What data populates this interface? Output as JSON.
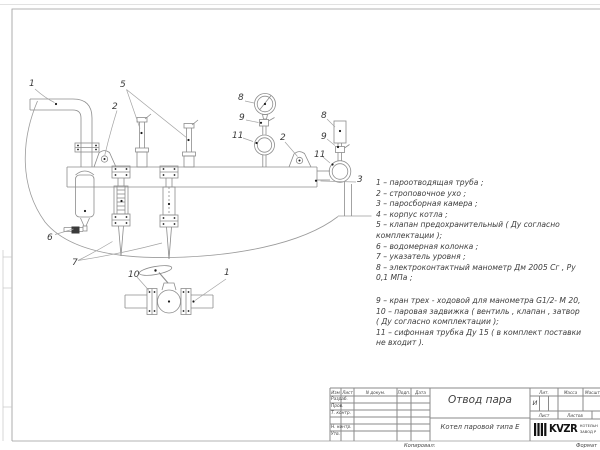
{
  "colors": {
    "drawing_line": "#8c8c8c",
    "frame_line": "#9a9a9a",
    "leader_line": "#a3a3a3",
    "text": "#3c3c3c",
    "dot": "#1b1b1b"
  },
  "drawing": {
    "callouts": [
      {
        "n": "1"
      },
      {
        "n": "5"
      },
      {
        "n": "2"
      },
      {
        "n": "8"
      },
      {
        "n": "9"
      },
      {
        "n": "11"
      },
      {
        "n": "2"
      },
      {
        "n": "8"
      },
      {
        "n": "9"
      },
      {
        "n": "11"
      },
      {
        "n": "3"
      },
      {
        "n": "6"
      },
      {
        "n": "7"
      },
      {
        "n": "10"
      },
      {
        "n": "1"
      }
    ]
  },
  "legend": {
    "lines": [
      "1 –  пароотводящая труба ;",
      "2 –  строповочное ухо ;",
      "3 –  паросборная камера ;",
      "4 –  корпус котла ;",
      "5 –  клапан предохранительный  ( Ду согласно",
      "комплектации );",
      "6 –  водомерная колонка ;",
      "7 – указатель уровня ;",
      "8 – электроконтактный манометр  Дм 2005 Сг ,  Ру",
      "0,1  МПа ;",
      "9 –  кран трех - ходовой для манометра   G1/2- М 20,",
      "10 –  паровая задвижка  ( вентиль ,  клапан ,  затвор",
      "( Ду согласно комплектации );",
      "11 –  сифонная трубка  Ду 15  ( в комплект поставки",
      "не входит )."
    ]
  },
  "title_block": {
    "title": "Отвод пара",
    "subtitle": "Котел паровой типа Е",
    "header_cols": [
      "Изм",
      "Лист",
      "N докум.",
      "Подп.",
      "Дата"
    ],
    "sign_rows": [
      "Разраб.",
      "Пров.",
      "Т. контр.",
      "Н. контр.",
      "Утв."
    ],
    "lit_label": "Лит.",
    "mass_label": "Масса",
    "scale_label": "Масштаб",
    "lit_value": "И",
    "sheet_label": "Лист",
    "sheets_label": "Листов",
    "logo_text": "KVZR",
    "company_line1": "КОТЕЛЬН",
    "company_line2": "ЗАВОД Р",
    "footer_copy": "Копировал:",
    "footer_format": "Формат"
  }
}
